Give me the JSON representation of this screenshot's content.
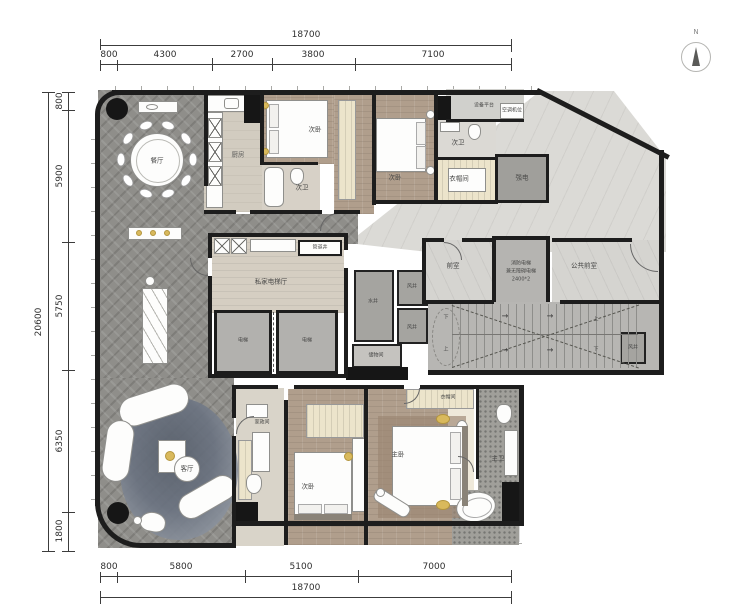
{
  "compass": {
    "label": "N"
  },
  "dimensions": {
    "top": {
      "total": "18700",
      "segs": [
        "800",
        "4300",
        "2700",
        "3800",
        "7100"
      ]
    },
    "left": {
      "total": "20600",
      "segs": [
        "800",
        "5900",
        "5750",
        "6350",
        "1800"
      ]
    },
    "bottom": {
      "total": "18700",
      "segs": [
        "800",
        "5800",
        "5100",
        "7000"
      ]
    }
  },
  "rooms": {
    "dining": "餐厅",
    "kitchen": "厨房",
    "bed_a": "次卧",
    "bath_a": "次卫",
    "bed_b": "次卧",
    "bath_b": "次卫",
    "equip_platform": "设备平台",
    "ac_unit": "空调机位",
    "closet_b": "衣帽间",
    "power": "强电",
    "pipe_shaft": "管道井",
    "lift_hall": "私家电梯厅",
    "lift": "电梯",
    "front_room": "前室",
    "fire_lift_l1": "消防电梯",
    "fire_lift_l2": "兼无障碍电梯",
    "fire_lift_l3": "2400*2",
    "public_front": "公共前室",
    "wind_shaft": "风井",
    "water_shaft": "水井",
    "storage": "储物间",
    "housekeeping": "家政间",
    "living": "客厅",
    "bed_c": "次卧",
    "master": "主卧",
    "closet_m": "衣帽间",
    "bath_m": "主卫"
  },
  "stairs": {
    "up": "上",
    "down": "下",
    "arrow": "→"
  }
}
